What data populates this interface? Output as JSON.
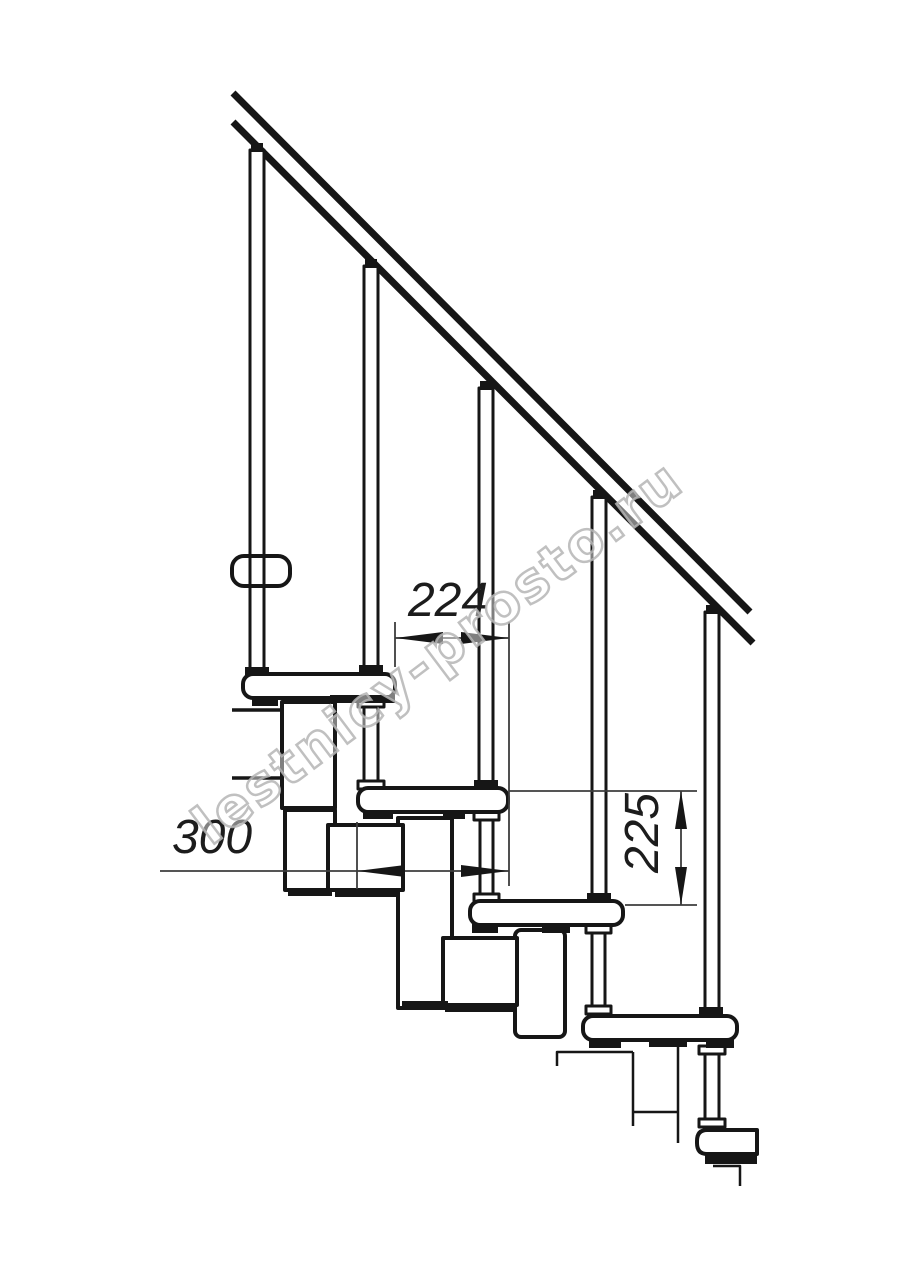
{
  "meta": {
    "description": "Technical side-view drawing of a modular staircase with handrail, balusters, treads and dimension callouts",
    "canvas": {
      "width": 914,
      "height": 1280
    },
    "colors": {
      "background": "#ffffff",
      "ink": "#161616",
      "dimension": "#3d3d3d",
      "watermark": "#b5b5b5"
    }
  },
  "dimensions": {
    "span": "224",
    "depth": "300",
    "rise": "225"
  },
  "watermark": {
    "text": "lestnicy-prosto.ru",
    "cx": 449,
    "cy": 667,
    "rotate": -37,
    "font_size": 54
  },
  "drawing": {
    "shapes": [
      {
        "t": "line",
        "n": "handrail-top-line",
        "p": [
          233,
          93,
          750,
          612
        ],
        "w": 7
      },
      {
        "t": "line",
        "n": "handrail-bottom-line",
        "p": [
          233,
          122,
          753,
          643
        ],
        "w": 7
      },
      {
        "t": "rect",
        "n": "baluster-1",
        "p": [
          250,
          150,
          14,
          526
        ],
        "sw": 3
      },
      {
        "t": "rect",
        "n": "baluster-2",
        "p": [
          364,
          266,
          14,
          402
        ],
        "sw": 3
      },
      {
        "t": "rect",
        "n": "baluster-3",
        "p": [
          479,
          388,
          14,
          394
        ],
        "sw": 3
      },
      {
        "t": "rect",
        "n": "baluster-4",
        "p": [
          592,
          497,
          14,
          398
        ],
        "sw": 3
      },
      {
        "t": "rect",
        "n": "baluster-5",
        "p": [
          705,
          612,
          14,
          398
        ],
        "sw": 3
      },
      {
        "t": "frect",
        "n": "baluster-1-rail-cap",
        "p": [
          251,
          143,
          12,
          9
        ]
      },
      {
        "t": "frect",
        "n": "baluster-2-rail-cap",
        "p": [
          365,
          259,
          12,
          9
        ]
      },
      {
        "t": "frect",
        "n": "baluster-3-rail-cap",
        "p": [
          480,
          381,
          12,
          9
        ]
      },
      {
        "t": "frect",
        "n": "baluster-4-rail-cap",
        "p": [
          593,
          490,
          12,
          9
        ]
      },
      {
        "t": "frect",
        "n": "baluster-5-rail-cap",
        "p": [
          706,
          605,
          12,
          9
        ]
      },
      {
        "t": "frect",
        "n": "baluster-1-foot",
        "p": [
          245,
          667,
          24,
          9
        ]
      },
      {
        "t": "frect",
        "n": "baluster-2-foot",
        "p": [
          359,
          665,
          24,
          9
        ]
      },
      {
        "t": "frect",
        "n": "baluster-3-foot",
        "p": [
          474,
          780,
          24,
          9
        ]
      },
      {
        "t": "frect",
        "n": "baluster-4-foot",
        "p": [
          587,
          893,
          24,
          9
        ]
      },
      {
        "t": "frect",
        "n": "baluster-5-foot",
        "p": [
          699,
          1007,
          24,
          9
        ]
      },
      {
        "t": "path",
        "n": "wall-bracket-outline",
        "d": "M232 710 H286 V778 H232",
        "sw": 3.5
      },
      {
        "t": "rect",
        "n": "module-box-1",
        "p": [
          282,
          702,
          53,
          106
        ],
        "sw": 4
      },
      {
        "t": "rect",
        "n": "module-box-2",
        "p": [
          285,
          810,
          50,
          80
        ],
        "sw": 4
      },
      {
        "t": "rect",
        "n": "module-column-mid",
        "p": [
          398,
          818,
          54,
          190
        ],
        "sw": 4
      },
      {
        "t": "rect",
        "n": "module-square-2",
        "p": [
          328,
          825,
          75,
          65
        ],
        "sw": 4
      },
      {
        "t": "rect",
        "n": "module-column-low",
        "p": [
          515,
          930,
          50,
          107
        ],
        "rx": 6,
        "sw": 4
      },
      {
        "t": "rect",
        "n": "module-square-3",
        "p": [
          443,
          938,
          74,
          67
        ],
        "sw": 4
      },
      {
        "t": "frect",
        "n": "module-box-2-base-bar",
        "p": [
          288,
          888,
          44,
          8
        ]
      },
      {
        "t": "frect",
        "n": "module-square-2-base-bar",
        "p": [
          335,
          889,
          63,
          8
        ]
      },
      {
        "t": "frect",
        "n": "module-column-mid-base-bar",
        "p": [
          402,
          1001,
          46,
          8
        ]
      },
      {
        "t": "frect",
        "n": "module-square-3-base-bar",
        "p": [
          445,
          1004,
          68,
          8
        ]
      },
      {
        "t": "rect",
        "n": "support-tube-2",
        "p": [
          364,
          700,
          14,
          88
        ],
        "sw": 3
      },
      {
        "t": "rect",
        "n": "support-tube-2-top-flare",
        "p": [
          358,
          699,
          26,
          8
        ],
        "sw": 3
      },
      {
        "t": "rect",
        "n": "support-tube-2-bottom-flare",
        "p": [
          358,
          781,
          26,
          8
        ],
        "sw": 3
      },
      {
        "t": "rect",
        "n": "support-tube-3",
        "p": [
          480,
          813,
          13,
          88
        ],
        "sw": 3
      },
      {
        "t": "rect",
        "n": "support-tube-3-top-flare",
        "p": [
          474,
          812,
          25,
          8
        ],
        "sw": 3
      },
      {
        "t": "rect",
        "n": "support-tube-3-bottom-flare",
        "p": [
          474,
          894,
          25,
          8
        ],
        "sw": 3
      },
      {
        "t": "rect",
        "n": "support-tube-4",
        "p": [
          592,
          926,
          13,
          88
        ],
        "sw": 3
      },
      {
        "t": "rect",
        "n": "support-tube-4-top-flare",
        "p": [
          586,
          925,
          25,
          8
        ],
        "sw": 3
      },
      {
        "t": "rect",
        "n": "support-tube-4-bottom-flare",
        "p": [
          586,
          1006,
          25,
          8
        ],
        "sw": 3
      },
      {
        "t": "rect",
        "n": "support-tube-5",
        "p": [
          705,
          1047,
          14,
          80
        ],
        "sw": 3
      },
      {
        "t": "rect",
        "n": "support-tube-5-top-flare",
        "p": [
          699,
          1046,
          26,
          8
        ],
        "sw": 3
      },
      {
        "t": "rect",
        "n": "support-tube-5-bottom-flare",
        "p": [
          699,
          1119,
          26,
          8
        ],
        "sw": 3
      },
      {
        "t": "path",
        "n": "lower-module-cut-line",
        "d": "M557 1066 V1052 H633",
        "sw": 2.5
      },
      {
        "t": "line",
        "n": "lower-module-left-edge",
        "p": [
          633,
          1052,
          633,
          1126
        ],
        "w": 2.5
      },
      {
        "t": "line",
        "n": "lower-module-right-edge",
        "p": [
          678,
          1046,
          678,
          1143
        ],
        "w": 2.5
      },
      {
        "t": "line",
        "n": "lower-module-bottom-edge",
        "p": [
          633,
          1112,
          678,
          1112
        ],
        "w": 2.5
      },
      {
        "t": "path",
        "n": "last-step-cut-line",
        "d": "M713 1166 H740 V1186",
        "sw": 2.5
      },
      {
        "t": "rect",
        "n": "tread-1",
        "p": [
          243,
          674,
          152,
          24
        ],
        "rx": 10,
        "sw": 4
      },
      {
        "t": "rect",
        "n": "tread-2",
        "p": [
          358,
          788,
          150,
          24
        ],
        "rx": 10,
        "sw": 4
      },
      {
        "t": "rect",
        "n": "tread-3",
        "p": [
          470,
          901,
          153,
          24
        ],
        "rx": 10,
        "sw": 4
      },
      {
        "t": "rect",
        "n": "tread-4",
        "p": [
          583,
          1016,
          154,
          24
        ],
        "rx": 10,
        "sw": 4
      },
      {
        "t": "path",
        "n": "tread-5-partial",
        "d": "M757 1130 H707 Q697 1130 697 1141 V1143 Q697 1154 707 1154 H757 Z",
        "sw": 4,
        "white": true
      },
      {
        "t": "frect",
        "n": "tread-1-left-clamp",
        "p": [
          252,
          697,
          26,
          9
        ]
      },
      {
        "t": "frect",
        "n": "tread-1-right-clamp",
        "p": [
          330,
          695,
          65,
          8
        ]
      },
      {
        "t": "frect",
        "n": "tread-2-left-clamp",
        "p": [
          363,
          811,
          30,
          8
        ]
      },
      {
        "t": "frect",
        "n": "tread-2-mid-clamp",
        "p": [
          443,
          811,
          22,
          8
        ]
      },
      {
        "t": "frect",
        "n": "tread-3-left-clamp",
        "p": [
          472,
          924,
          26,
          9
        ]
      },
      {
        "t": "frect",
        "n": "tread-3-mid-clamp",
        "p": [
          542,
          924,
          28,
          9
        ]
      },
      {
        "t": "frect",
        "n": "tread-4-left-clamp",
        "p": [
          589,
          1039,
          32,
          9
        ]
      },
      {
        "t": "frect",
        "n": "tread-4-mid-clamp",
        "p": [
          649,
          1039,
          38,
          8
        ]
      },
      {
        "t": "frect",
        "n": "tread-4-right-clamp",
        "p": [
          706,
          1039,
          28,
          9
        ]
      },
      {
        "t": "frect",
        "n": "tread-5-clamp",
        "p": [
          705,
          1153,
          52,
          11
        ]
      },
      {
        "t": "rect",
        "n": "baluster-1-bracket",
        "p": [
          232,
          556,
          58,
          30
        ],
        "rx": 12,
        "sw": 4,
        "nofill": true
      },
      {
        "t": "line",
        "n": "dim-224-ext-left",
        "p": [
          395,
          622,
          395,
          667
        ],
        "w": 1.8,
        "c": "dim"
      },
      {
        "t": "line",
        "n": "dim-224-ext-right",
        "p": [
          509,
          622,
          509,
          886
        ],
        "w": 1.8,
        "c": "dim"
      },
      {
        "t": "line",
        "n": "dim-224-line",
        "p": [
          395,
          638,
          509,
          638
        ],
        "w": 1.8,
        "c": "dim"
      },
      {
        "t": "line",
        "n": "dim-300-ext-left",
        "p": [
          357,
          822,
          357,
          889
        ],
        "w": 1.8,
        "c": "dim"
      },
      {
        "t": "line",
        "n": "dim-300-line",
        "p": [
          160,
          871,
          509,
          871
        ],
        "w": 1.8,
        "c": "dim"
      },
      {
        "t": "line",
        "n": "dim-225-ext-top",
        "p": [
          509,
          791,
          697,
          791
        ],
        "w": 1.8,
        "c": "dim"
      },
      {
        "t": "line",
        "n": "dim-225-ext-bottom",
        "p": [
          625,
          905,
          697,
          905
        ],
        "w": 1.8,
        "c": "dim"
      },
      {
        "t": "line",
        "n": "dim-225-line",
        "p": [
          681,
          791,
          681,
          905
        ],
        "w": 1.8,
        "c": "dim"
      },
      {
        "t": "poly",
        "n": "dim-224-arrow-left",
        "pts": "395,638 443,632 443,644"
      },
      {
        "t": "poly",
        "n": "dim-224-arrow-right",
        "pts": "509,638 461,632 461,644"
      },
      {
        "t": "poly",
        "n": "dim-300-arrow-left",
        "pts": "357,871 405,865 405,877"
      },
      {
        "t": "poly",
        "n": "dim-300-arrow-right",
        "pts": "509,871 461,865 461,877"
      },
      {
        "t": "poly",
        "n": "dim-225-arrow-up",
        "pts": "681,791 675,829 687,829"
      },
      {
        "t": "poly",
        "n": "dim-225-arrow-down",
        "pts": "681,905 675,867 687,867"
      },
      {
        "t": "text",
        "n": "dim-label-224",
        "bind": "dimensions.span",
        "x": 448,
        "y": 616,
        "size": 48
      },
      {
        "t": "text",
        "n": "dim-label-300",
        "bind": "dimensions.depth",
        "x": 212,
        "y": 853,
        "size": 48
      },
      {
        "t": "text",
        "n": "dim-label-225",
        "bind": "dimensions.rise",
        "x": 658,
        "y": 833,
        "size": 48,
        "rot": -90
      }
    ]
  }
}
